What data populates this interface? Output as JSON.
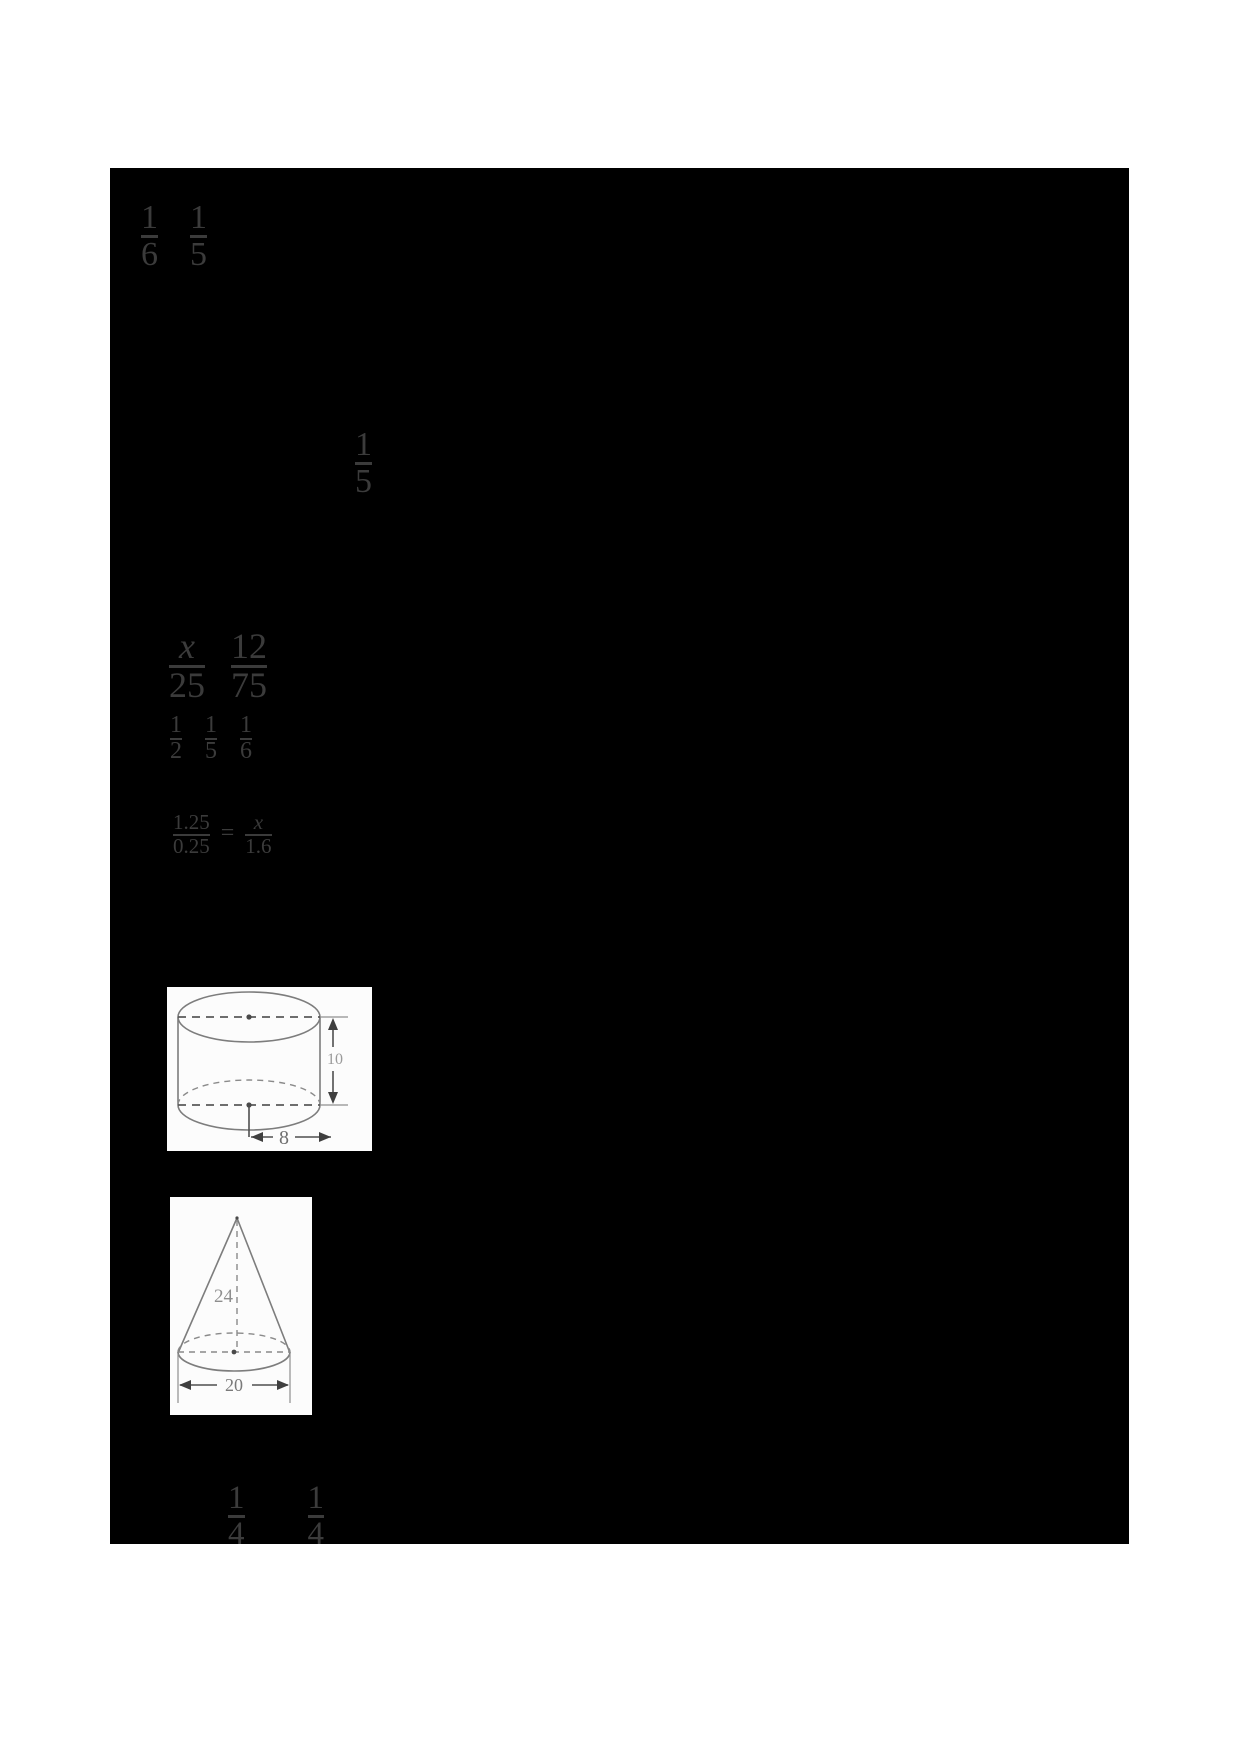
{
  "math": {
    "top_pair": [
      {
        "num": "1",
        "den": "6"
      },
      {
        "num": "1",
        "den": "5"
      }
    ],
    "mid_single": {
      "num": "1",
      "den": "5"
    },
    "proportion_pair": [
      {
        "num": "x",
        "den": "25"
      },
      {
        "num": "12",
        "den": "75"
      }
    ],
    "small_triple": [
      {
        "num": "1",
        "den": "2"
      },
      {
        "num": "1",
        "den": "5"
      },
      {
        "num": "1",
        "den": "6"
      }
    ],
    "decimal_equation": {
      "left": {
        "num": "1.25",
        "den": "0.25"
      },
      "equals": "=",
      "right": {
        "num": "x",
        "den": "1.6"
      }
    },
    "bottom_pair": [
      {
        "num": "1",
        "den": "4"
      },
      {
        "num": "1",
        "den": "4"
      }
    ]
  },
  "figures": {
    "cylinder": {
      "height_label": "10",
      "radius_label": "8"
    },
    "cone": {
      "height_label": "24",
      "diameter_label": "20"
    }
  },
  "colors": {
    "page_background": "#ffffff",
    "redaction_fill": "#000000",
    "math_text": "#3b3b3b",
    "figure_background": "#fcfcfc",
    "figure_stroke": "#7d7d7d",
    "dimension_stroke": "#4f4f4f"
  }
}
